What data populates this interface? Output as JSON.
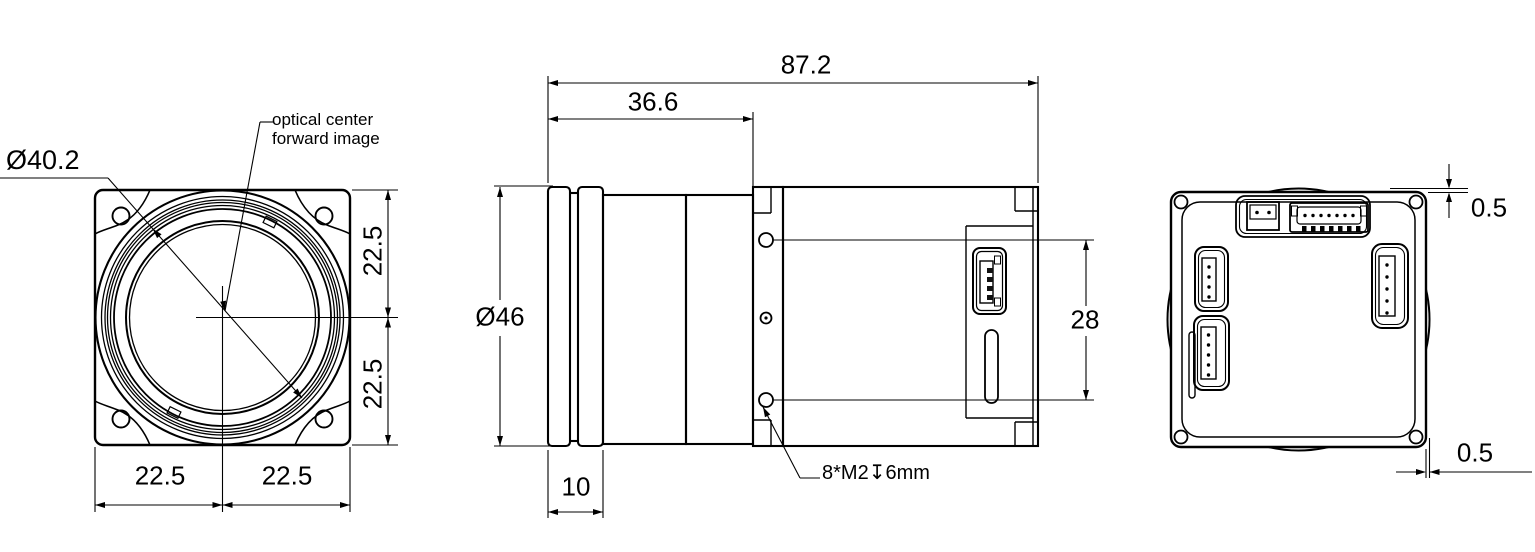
{
  "drawing_title": "industrial camera dimensional drawing",
  "front_view": {
    "diameter_label": "Ø40.2",
    "note_line1": "optical center",
    "note_line2": "forward image",
    "dim_right_upper": "22.5",
    "dim_right_lower": "22.5",
    "dim_bottom_left": "22.5",
    "dim_bottom_right": "22.5"
  },
  "side_view": {
    "dim_overall_length": "87.2",
    "dim_front_section": "36.6",
    "lens_diameter_label": "Ø46",
    "dim_ring_width": "10",
    "dim_hole_span": "28",
    "thread_callout": "8*M2↧6mm"
  },
  "back_view": {
    "dim_top_protrusion": "0.5",
    "dim_side_protrusion": "0.5"
  }
}
